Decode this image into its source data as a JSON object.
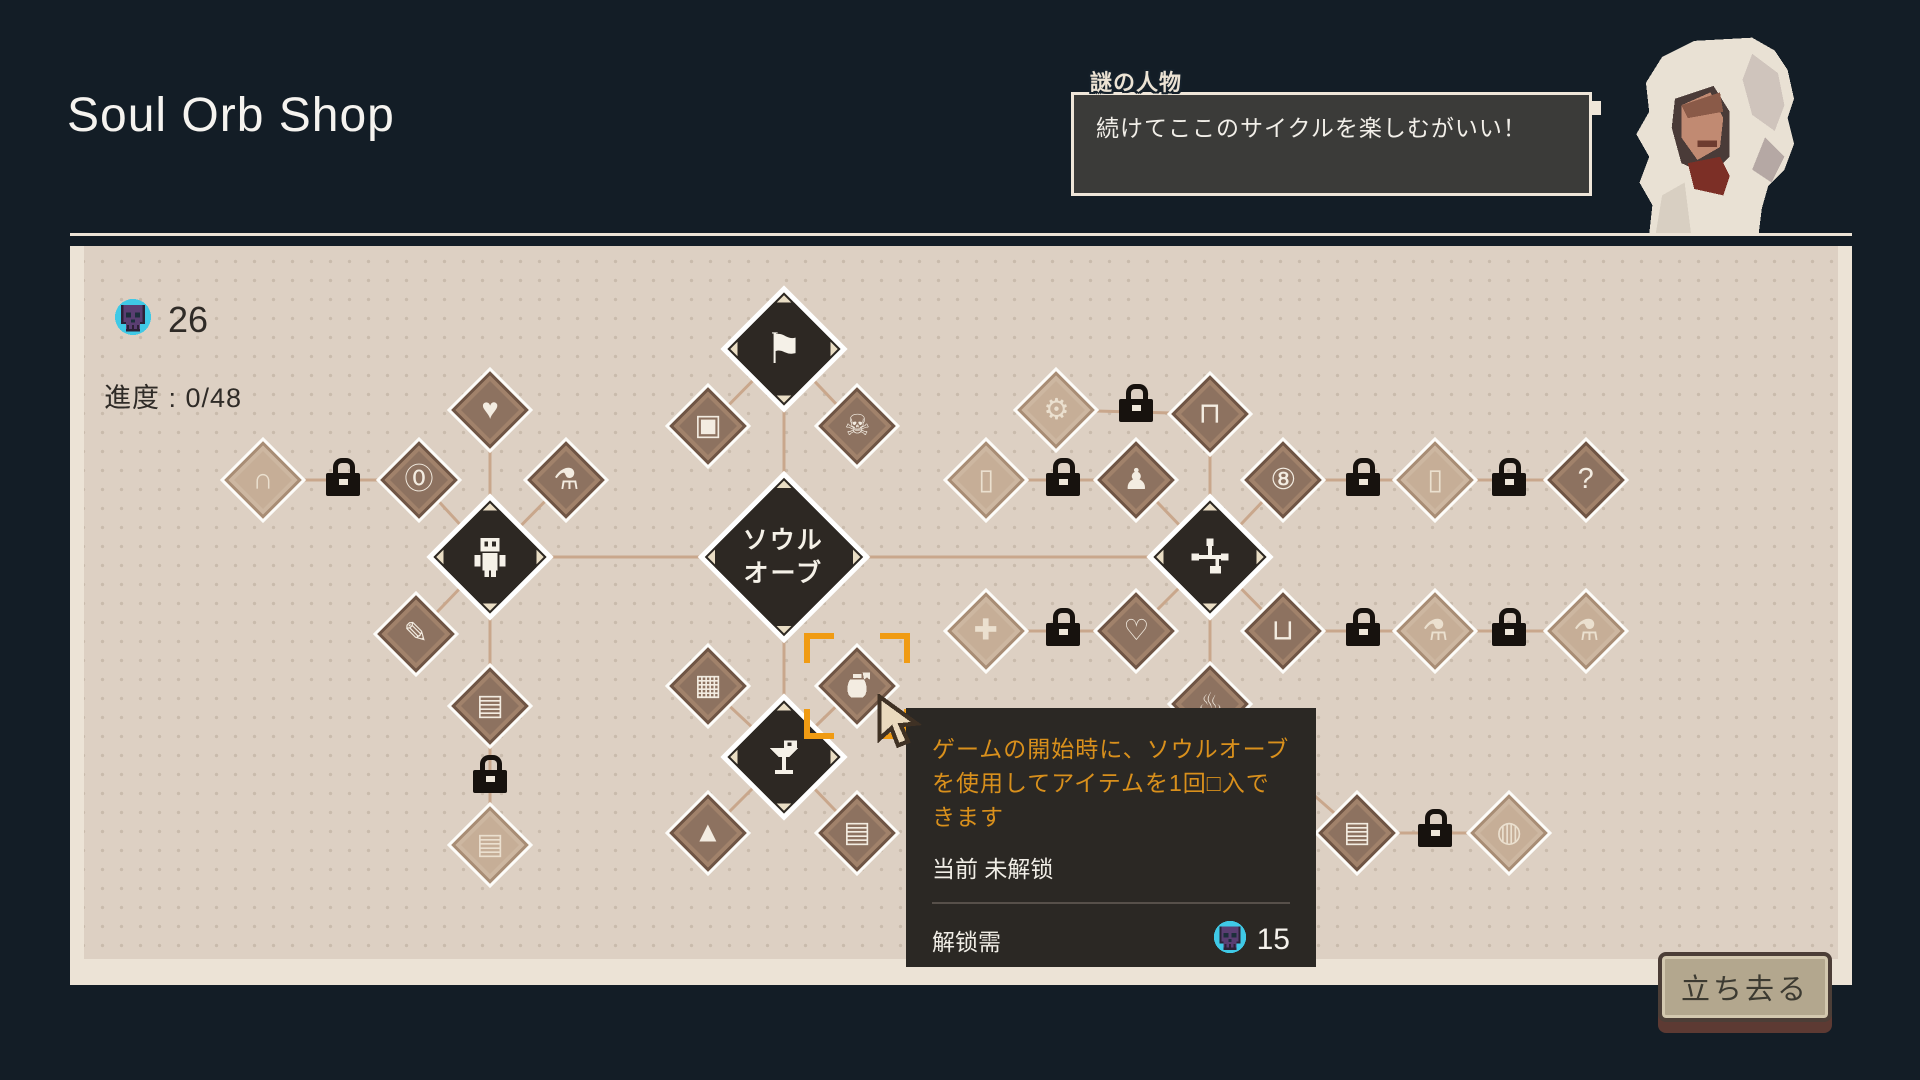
{
  "page_title": "Soul Orb Shop",
  "dialogue": {
    "speaker": "謎の人物",
    "text": "続けてここのサイクルを楽しむがいい！"
  },
  "currency": {
    "icon": "soul-skull-icon",
    "amount": "26"
  },
  "progress": {
    "label": "進度 : 0/48"
  },
  "tooltip": {
    "description": "ゲームの開始時に、ソウルオーブを使用してアイテムを1回□入できます",
    "status": "当前 未解锁",
    "unlock_label": "解锁需",
    "unlock_cost": "15",
    "cost_icon": "soul-skull-icon"
  },
  "leave_button": "立ち去る",
  "colors": {
    "background": "#131d26",
    "panel_bg": "#ddd0c3",
    "panel_border": "#ece3d6",
    "panel_dots": "#c9bbac",
    "node_dark": "#2d2823",
    "node_medium": "#8d7260",
    "node_light": "#c6ae97",
    "line": "#c9a78c",
    "accent_orange": "#f09b13",
    "tooltip_bg": "#2b2824",
    "tooltip_text_orange": "#d9901c",
    "lock_black": "#17120e",
    "skull_purple": "#5a3e72",
    "skull_cyan": "#3fc9e6",
    "button_face": "#b3a78e",
    "button_shadow": "#5d3a33"
  },
  "tree": {
    "line_color": "#c9a78c",
    "selection": {
      "node": "start-purchase",
      "x": 857,
      "y": 686
    },
    "nodes": [
      {
        "id": "grave",
        "icon": "tombstone-icon",
        "glyph": "∩",
        "state": "dim",
        "kind": "s",
        "x": 263,
        "y": 480
      },
      {
        "id": "coin-zero",
        "icon": "coin-zero-icon",
        "glyph": "⓪",
        "state": "avail",
        "kind": "s",
        "x": 419,
        "y": 480
      },
      {
        "id": "heart",
        "icon": "heart-icon",
        "glyph": "♥",
        "state": "avail",
        "kind": "s",
        "x": 490,
        "y": 410
      },
      {
        "id": "potion",
        "icon": "potion-icon",
        "glyph": "⚗",
        "state": "avail",
        "kind": "s",
        "x": 566,
        "y": 480
      },
      {
        "id": "robot",
        "icon": "robot-icon",
        "svg": "robot",
        "state": "core",
        "kind": "l",
        "x": 490,
        "y": 557
      },
      {
        "id": "pencil",
        "icon": "pencil-plus-icon",
        "glyph": "✎",
        "state": "avail",
        "kind": "s",
        "x": 416,
        "y": 634
      },
      {
        "id": "canister-lock",
        "icon": "canister-lock-icon",
        "glyph": "▤",
        "state": "avail",
        "kind": "s",
        "x": 490,
        "y": 706
      },
      {
        "id": "canister-dim",
        "icon": "canister-icon",
        "glyph": "▤",
        "state": "dim",
        "kind": "s",
        "x": 490,
        "y": 845
      },
      {
        "id": "flag",
        "icon": "torn-flag-icon",
        "glyph": "⚑",
        "state": "core",
        "kind": "l",
        "x": 784,
        "y": 349
      },
      {
        "id": "crate",
        "icon": "crate-icon",
        "glyph": "▣",
        "state": "avail",
        "kind": "s",
        "x": 708,
        "y": 426
      },
      {
        "id": "skull-coin",
        "icon": "skull-coin-icon",
        "glyph": "☠",
        "state": "avail",
        "kind": "s",
        "x": 857,
        "y": 426
      },
      {
        "id": "soul-orb",
        "icon": "soul-orb-node",
        "label": [
          "ソウル",
          "オーブ"
        ],
        "state": "core",
        "kind": "h",
        "x": 784,
        "y": 557
      },
      {
        "id": "chest",
        "icon": "chest-icon",
        "glyph": "▦",
        "state": "avail",
        "kind": "s",
        "x": 708,
        "y": 686
      },
      {
        "id": "start-purchase",
        "icon": "money-pouch-icon",
        "svg": "pouch",
        "state": "avail",
        "kind": "s",
        "x": 857,
        "y": 686
      },
      {
        "id": "pedestal",
        "icon": "item-pedestal-icon",
        "svg": "pedestal",
        "state": "core",
        "kind": "l",
        "x": 784,
        "y": 757
      },
      {
        "id": "mountain",
        "icon": "mountain-icon",
        "glyph": "▲",
        "state": "avail",
        "kind": "s",
        "x": 708,
        "y": 833
      },
      {
        "id": "canister-plus",
        "icon": "canister-plus-icon",
        "glyph": "▤",
        "state": "avail",
        "kind": "s",
        "x": 857,
        "y": 833
      },
      {
        "id": "gear",
        "icon": "gear-icon",
        "glyph": "⚙",
        "state": "dim",
        "kind": "s",
        "x": 1056,
        "y": 410
      },
      {
        "id": "jar",
        "icon": "jar-icon",
        "glyph": "⊓",
        "state": "avail",
        "kind": "s",
        "x": 1210,
        "y": 414
      },
      {
        "id": "card-plus",
        "icon": "card-plus-icon",
        "glyph": "▯",
        "state": "dim",
        "kind": "s",
        "x": 986,
        "y": 480
      },
      {
        "id": "ghost",
        "icon": "ghost-doll-icon",
        "glyph": "♟",
        "state": "avail",
        "kind": "s",
        "x": 1136,
        "y": 480
      },
      {
        "id": "network",
        "icon": "skill-network-icon",
        "svg": "network",
        "state": "core",
        "kind": "l",
        "x": 1210,
        "y": 557
      },
      {
        "id": "banner-eight",
        "icon": "banner-eight-icon",
        "glyph": "⑧",
        "state": "avail",
        "kind": "s",
        "x": 1283,
        "y": 480
      },
      {
        "id": "card-up",
        "icon": "card-upgrade-icon",
        "glyph": "▯",
        "state": "dim",
        "kind": "s",
        "x": 1435,
        "y": 480
      },
      {
        "id": "card-question",
        "icon": "card-question-icon",
        "glyph": "?",
        "state": "avail",
        "kind": "s",
        "x": 1586,
        "y": 480
      },
      {
        "id": "cross",
        "icon": "cross-plus-icon",
        "glyph": "✚",
        "state": "dim",
        "kind": "s",
        "x": 986,
        "y": 631
      },
      {
        "id": "heart-box",
        "icon": "heart-box-icon",
        "glyph": "♡",
        "state": "avail",
        "kind": "s",
        "x": 1136,
        "y": 631
      },
      {
        "id": "banner-flask",
        "icon": "banner-flask-icon",
        "glyph": "⊔",
        "state": "avail",
        "kind": "s",
        "x": 1283,
        "y": 631
      },
      {
        "id": "spray",
        "icon": "spray-sparkle-icon",
        "glyph": "⚗",
        "state": "dim",
        "kind": "s",
        "x": 1435,
        "y": 631
      },
      {
        "id": "flask-plus",
        "icon": "flask-plus-icon",
        "glyph": "⚗",
        "state": "dim",
        "kind": "s",
        "x": 1586,
        "y": 631
      },
      {
        "id": "torch",
        "icon": "torch-flame-icon",
        "glyph": "♨",
        "state": "avail",
        "kind": "s",
        "x": 1210,
        "y": 704
      },
      {
        "id": "canister-spark",
        "icon": "canister-sparkle-icon",
        "glyph": "▤",
        "state": "avail",
        "kind": "s",
        "x": 1357,
        "y": 833
      },
      {
        "id": "bowl",
        "icon": "bowl-icon",
        "glyph": "◍",
        "state": "dim",
        "kind": "s",
        "x": 1509,
        "y": 833
      }
    ],
    "locks": [
      [
        343,
        480
      ],
      [
        490,
        777
      ],
      [
        1136,
        406
      ],
      [
        1063,
        480
      ],
      [
        1363,
        480
      ],
      [
        1509,
        480
      ],
      [
        1063,
        630
      ],
      [
        1363,
        630
      ],
      [
        1509,
        630
      ],
      [
        1435,
        831
      ]
    ],
    "edges": [
      [
        263,
        480,
        419,
        480
      ],
      [
        419,
        480,
        490,
        557
      ],
      [
        490,
        410,
        490,
        557
      ],
      [
        566,
        480,
        490,
        557
      ],
      [
        416,
        634,
        490,
        557
      ],
      [
        490,
        557,
        490,
        845
      ],
      [
        490,
        557,
        784,
        557
      ],
      [
        708,
        426,
        784,
        349
      ],
      [
        857,
        426,
        784,
        349
      ],
      [
        784,
        349,
        784,
        557
      ],
      [
        784,
        557,
        784,
        757
      ],
      [
        708,
        686,
        784,
        757
      ],
      [
        857,
        686,
        784,
        757
      ],
      [
        708,
        833,
        784,
        757
      ],
      [
        857,
        833,
        784,
        757
      ],
      [
        784,
        557,
        1210,
        557
      ],
      [
        1056,
        410,
        1210,
        414
      ],
      [
        1210,
        414,
        1210,
        557
      ],
      [
        986,
        480,
        1136,
        480
      ],
      [
        1136,
        480,
        1210,
        557
      ],
      [
        1283,
        480,
        1210,
        557
      ],
      [
        1283,
        480,
        1586,
        480
      ],
      [
        986,
        631,
        1136,
        631
      ],
      [
        1136,
        631,
        1210,
        557
      ],
      [
        1283,
        631,
        1210,
        557
      ],
      [
        1283,
        631,
        1586,
        631
      ],
      [
        1210,
        557,
        1210,
        704
      ],
      [
        1210,
        704,
        1357,
        833
      ],
      [
        1357,
        833,
        1509,
        833
      ]
    ]
  }
}
